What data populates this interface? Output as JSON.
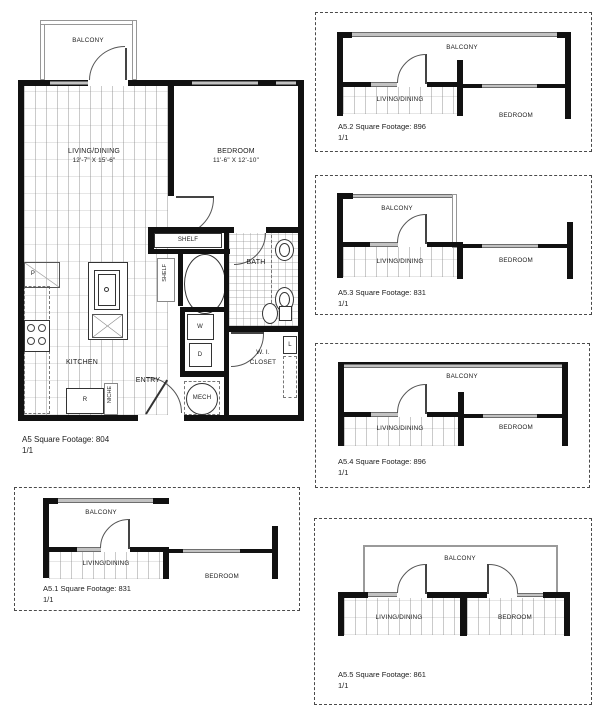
{
  "main_plan": {
    "caption": "A5 Square Footage: 804",
    "sheet": "1/1",
    "rooms": {
      "balcony": "BALCONY",
      "living": "LIVING/DINING",
      "living_dims": "12'-7\" X 15'-6\"",
      "bedroom": "BEDROOM",
      "bedroom_dims": "11'-6\" X 12'-10\"",
      "bath": "BATH",
      "kitchen": "KITCHEN",
      "entry": "ENTRY",
      "wi_closet_l1": "W. I.",
      "wi_closet_l2": "CLOSET",
      "mech": "MECH",
      "shelf_top": "SHELF",
      "shelf_side": "SHELF",
      "washer": "W",
      "dryer": "D",
      "pantry": "P",
      "refrigerator": "R",
      "linen": "L",
      "niche": "NICHE"
    }
  },
  "variants": [
    {
      "id": "A5.1",
      "caption": "A5.1 Square Footage: 831",
      "sheet": "1/1",
      "balcony": "BALCONY",
      "living": "LIVING/DINING",
      "bedroom": "BEDROOM"
    },
    {
      "id": "A5.2",
      "caption": "A5.2 Square Footage: 896",
      "sheet": "1/1",
      "balcony": "BALCONY",
      "living": "LIVING/DINING",
      "bedroom": "BEDROOM"
    },
    {
      "id": "A5.3",
      "caption": "A5.3 Square Footage: 831",
      "sheet": "1/1",
      "balcony": "BALCONY",
      "living": "LIVING/DINING",
      "bedroom": "BEDROOM"
    },
    {
      "id": "A5.4",
      "caption": "A5.4 Square Footage: 896",
      "sheet": "1/1",
      "balcony": "BALCONY",
      "living": "LIVING/DINING",
      "bedroom": "BEDROOM"
    },
    {
      "id": "A5.5",
      "caption": "A5.5 Square Footage: 861",
      "sheet": "1/1",
      "balcony": "BALCONY",
      "living": "LIVING/DINING",
      "bedroom": "BEDROOM"
    }
  ],
  "colors": {
    "wall": "#111111",
    "window_gray": "#c2c2c2",
    "rail_gray": "#9a9a9a",
    "text": "#1c1c1c",
    "dashed_border": "#4a4a4a",
    "background": "#ffffff"
  }
}
